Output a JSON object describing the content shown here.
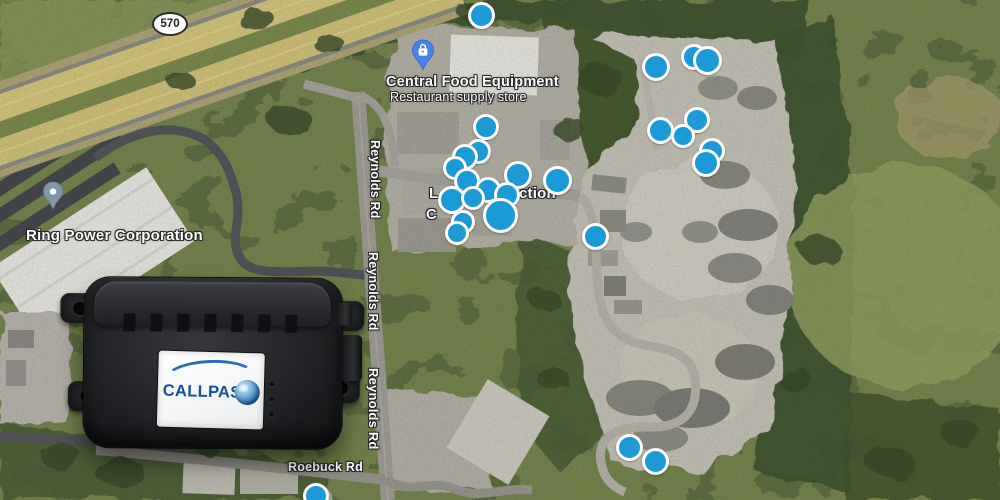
{
  "map": {
    "highway_shield": "570",
    "poi_store": {
      "name": "Central Food Equipment",
      "subtitle": "Restaurant supply store"
    },
    "poi_company": {
      "name": "Ring Power Corporation"
    },
    "obscured_poi_fragments": {
      "line1_left": "L",
      "line1_right": "ction",
      "line2_left": "C"
    },
    "road_labels": {
      "reynolds": "Reynolds Rd",
      "roebuck": "Roebuck Rd"
    },
    "colors": {
      "dot_fill": "#1b9ad8",
      "dot_border": "#ffffff",
      "store_pin": "#4a82ec",
      "generic_pin": "#8097a8"
    },
    "dots": [
      [
        481,
        15,
        27
      ],
      [
        486,
        127,
        26
      ],
      [
        478,
        151,
        25
      ],
      [
        465,
        157,
        26
      ],
      [
        455,
        168,
        24
      ],
      [
        467,
        181,
        26
      ],
      [
        518,
        175,
        28
      ],
      [
        557,
        180,
        29
      ],
      [
        488,
        190,
        26
      ],
      [
        507,
        195,
        26
      ],
      [
        452,
        200,
        28
      ],
      [
        473,
        198,
        24
      ],
      [
        500,
        215,
        35
      ],
      [
        463,
        222,
        24
      ],
      [
        457,
        233,
        24
      ],
      [
        595,
        236,
        27
      ],
      [
        656,
        67,
        28
      ],
      [
        694,
        57,
        26
      ],
      [
        707,
        60,
        29
      ],
      [
        697,
        120,
        26
      ],
      [
        660,
        130,
        27
      ],
      [
        683,
        136,
        24
      ],
      [
        712,
        151,
        26
      ],
      [
        706,
        163,
        28
      ],
      [
        629,
        447,
        27
      ],
      [
        655,
        461,
        27
      ],
      [
        316,
        496,
        26
      ]
    ]
  },
  "device": {
    "brand": "CALLPASS"
  }
}
